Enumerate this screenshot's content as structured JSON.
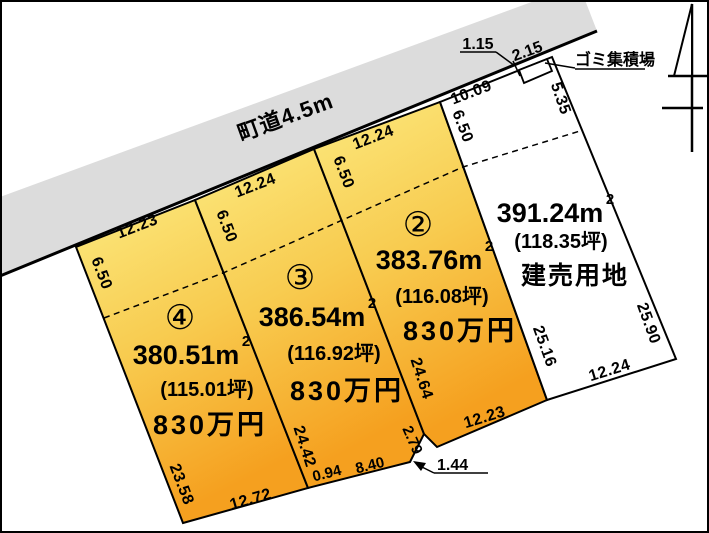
{
  "road": {
    "label": "町道4.5m"
  },
  "garbage_station": {
    "label": "ゴミ集積場",
    "width": "2.15",
    "offset": "1.15"
  },
  "plots": [
    {
      "id": "④",
      "area": "380.51m",
      "area_sup": "2",
      "tsubo": "(115.01坪)",
      "price": "830万円"
    },
    {
      "id": "③",
      "area": "386.54m",
      "area_sup": "2",
      "tsubo": "(116.92坪)",
      "price": "830万円"
    },
    {
      "id": "②",
      "area": "383.76m",
      "area_sup": "2",
      "tsubo": "(116.08坪)",
      "price": "830万円"
    },
    {
      "id": "",
      "area": "391.24m",
      "area_sup": "2",
      "tsubo": "(118.35坪)",
      "use": "建売用地"
    }
  ],
  "dims": {
    "p4_top": "12.23",
    "p4_left_top": "6.50",
    "p4_left": "23.58",
    "p4_bottom": "12.72",
    "b43_top": "6.50",
    "b43_low": "24.42",
    "p3_top": "12.24",
    "p3_bottom_a": "0.94",
    "p3_bottom_b": "8.40",
    "b32_top": "6.50",
    "b32_low": "24.64",
    "p2_top": "12.24",
    "p2_notch": "2.79",
    "p2_step": "1.44",
    "p2_bottom": "12.23",
    "b2r_top": "6.50",
    "b2r_low": "25.16",
    "r_top": "10.09",
    "r_right_top": "5.35",
    "r_right": "25.90",
    "r_bottom": "12.24"
  },
  "colors": {
    "road_gray": "#dcdcdc",
    "plot_gradient_top": "#fbe97e",
    "plot_gradient_mid": "#f8cb4f",
    "plot_gradient_bottom": "#f5a01f",
    "outline": "#000000",
    "background": "#ffffff"
  }
}
